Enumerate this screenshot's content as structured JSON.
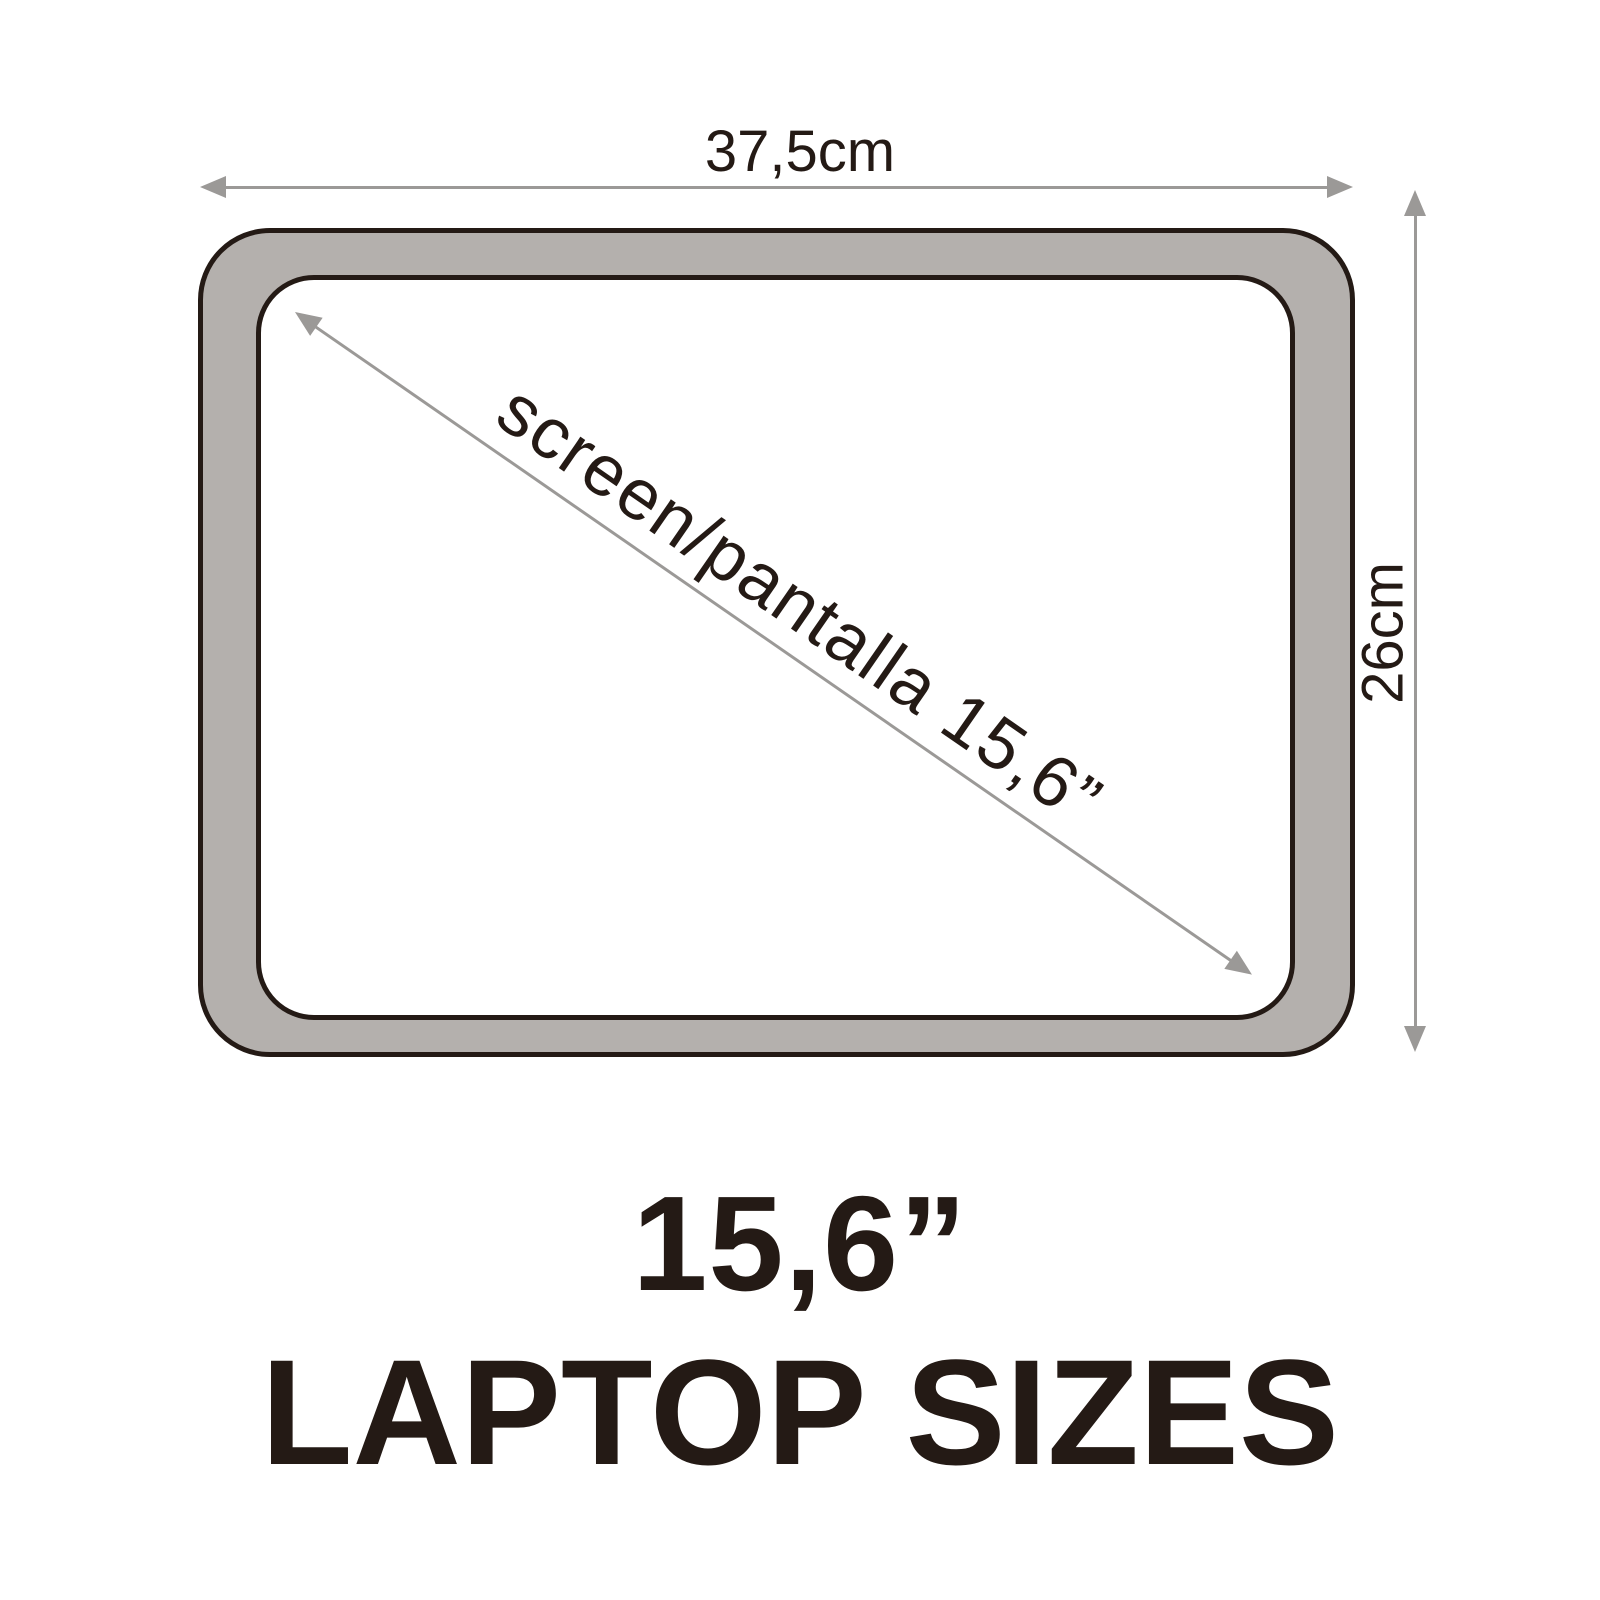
{
  "diagram": {
    "kind": "laptop-size-diagram",
    "dimensions": {
      "width_label": "37,5cm",
      "height_label": "26cm",
      "diagonal_label": "screen/pantalla 15,6”"
    },
    "title": {
      "size_label": "15,6”",
      "caption": "LAPTOP SIZES"
    },
    "icons": [
      "arrow-left-icon",
      "arrow-right-icon",
      "arrow-up-icon",
      "arrow-down-icon",
      "diag-arrow-upleft-icon",
      "diag-arrow-downright-icon"
    ],
    "colors": {
      "background": "#ffffff",
      "bezel_fill": "#b4b0ad",
      "outline": "#241a15",
      "arrow_grey": "#9b9997",
      "text_dark": "#241a15"
    }
  }
}
